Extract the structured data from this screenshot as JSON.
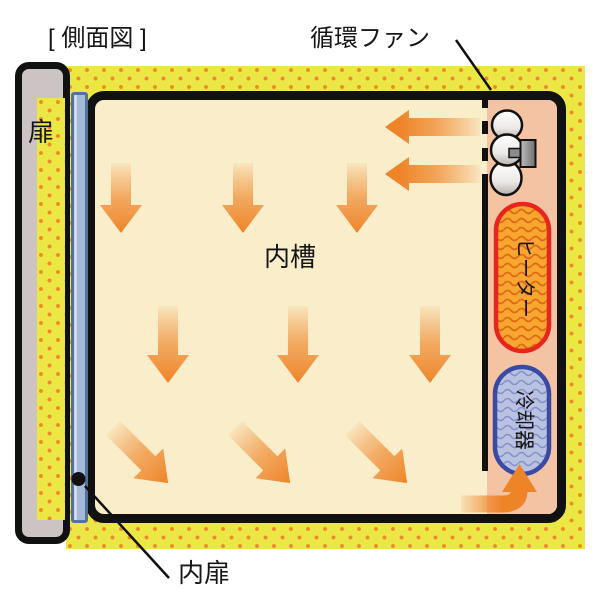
{
  "diagram": {
    "title": "[ 側面図 ]",
    "labels": {
      "door": "扉",
      "circulation_fan": "循環ファン",
      "inner_chamber": "内槽",
      "heater": "ヒーター",
      "cooler": "冷却器",
      "inner_door": "内扉"
    },
    "colors": {
      "insulation_yellow": "#ebe845",
      "insulation_dot_orange": "#ee8a2c",
      "chamber_cream": "#f9edca",
      "duct_salmon": "#f4c3a3",
      "airflow_arrow_orange": "#ee8428",
      "heater_fill": "#f9a630",
      "heater_border": "#e6251c",
      "cooler_fill": "#bac2e2",
      "cooler_border": "#3a49a3",
      "door_gray": "#ccc4c4",
      "inner_door_blue": "#a3bad8",
      "outline_black": "#111111"
    }
  }
}
